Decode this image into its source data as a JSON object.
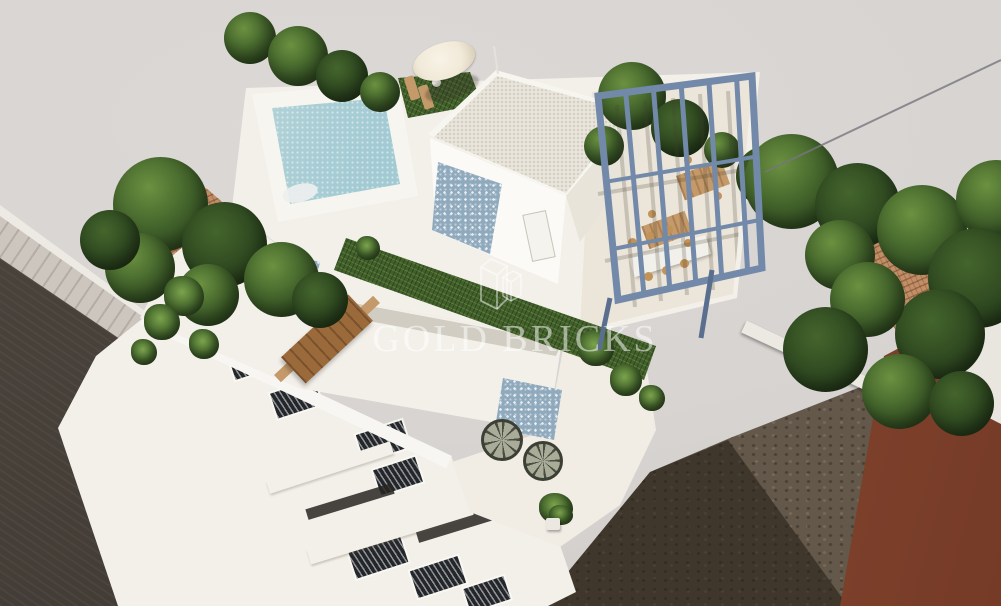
{
  "meta": {
    "type": "architectural-3d-render",
    "view": "aerial corner view of a modern two-storey villa with roof terrace"
  },
  "watermark": {
    "brand": "GOLD BRICKS",
    "logo": "two outlined 3D bricks"
  },
  "colors": {
    "bg": "#d8d4d2",
    "road": "#474039",
    "sidewalk": "#cdc6bf",
    "dirt": "#63584a",
    "shadow": "#241d14",
    "white": "#f3f0ea",
    "cream": "#ece5d9",
    "poolLight": "#d3e5e2",
    "poolMid": "#8fc0cf",
    "poolDeep": "#5f9fc2",
    "mosaic": "#8fa9bd",
    "turf": "#42602c",
    "treeDark": "#2c451f",
    "treeMid": "#44652c",
    "treeLight": "#6b9140",
    "pergola": "#7289a9",
    "pergolaDark": "#5a6f8e",
    "wood": "#9b6a3b",
    "woodLight": "#c49a6a",
    "tileRoof": "#c08f68",
    "redWall": "#8f4a32",
    "redWallLight": "#a65a3d",
    "redWallDark": "#753b27",
    "umbrella": "#f1e9d8",
    "windowDark": "#23262a",
    "watermark": "rgba(255,255,255,0.52)"
  },
  "scene": {
    "objects": [
      {
        "name": "street-road",
        "label": "asphalt street, lower left"
      },
      {
        "name": "sidewalk",
        "label": "paved sidewalk along street"
      },
      {
        "name": "villa",
        "label": "white modern villa with stepped terraces"
      },
      {
        "name": "swimming-pool",
        "label": "rooftop mosaic pool"
      },
      {
        "name": "parasol",
        "label": "white parasol with two sun loungers"
      },
      {
        "name": "penthouse",
        "label": "roof access box with mosaic tile wall"
      },
      {
        "name": "pergola",
        "label": "steel-blue pergola over dining terrace"
      },
      {
        "name": "roof-garden",
        "label": "artificial turf strip"
      },
      {
        "name": "dining-table",
        "label": "long wooden table with benches"
      },
      {
        "name": "lounge-chairs",
        "label": "two round wicker chairs with side table"
      },
      {
        "name": "neighbor-roof-left",
        "label": "neighbouring terracotta roof in trees"
      },
      {
        "name": "neighbor-roof-right",
        "label": "neighbouring terracotta roof in trees"
      },
      {
        "name": "neighbor-red-building",
        "label": "red-brown building, lower right"
      },
      {
        "name": "vacant-ground",
        "label": "bare earth plot with building shadow"
      }
    ]
  }
}
